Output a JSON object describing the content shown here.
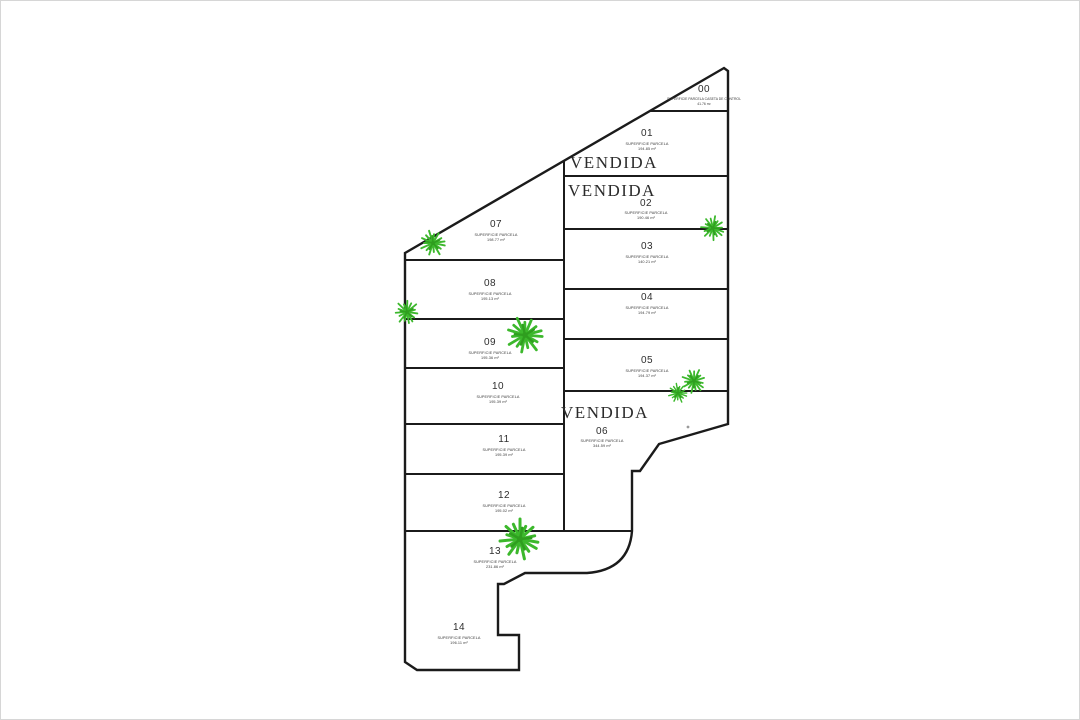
{
  "page": {
    "type": "parcel-plan",
    "background": "#ffffff",
    "border_color": "#d6d6d6",
    "line_color": "#1b1b1b",
    "palm_green": "#3cb82c",
    "palm_green_dark": "#2f9e1f",
    "text_color": "#2e2e2e"
  },
  "labels": {
    "superficie": "SUPERFICIE PARCELA",
    "superficie_caseta": "SUPERFICIE PARCELA CASETA DE CONTROL",
    "vendida": "VENDIDA"
  },
  "parcels": [
    {
      "number": "00",
      "area": "41.76 m²"
    },
    {
      "number": "01",
      "area": "194.85 m²",
      "status": "VENDIDA"
    },
    {
      "number": "02",
      "area": "190.46 m²",
      "status": "VENDIDA"
    },
    {
      "number": "03",
      "area": "140.21 m²"
    },
    {
      "number": "04",
      "area": "194.79 m²"
    },
    {
      "number": "05",
      "area": "194.37 m²"
    },
    {
      "number": "06",
      "area": "344.59 m²",
      "status": "VENDIDA"
    },
    {
      "number": "07",
      "area": "198.77 m²"
    },
    {
      "number": "08",
      "area": "195.13 m²"
    },
    {
      "number": "09",
      "area": "195.36 m²"
    },
    {
      "number": "10",
      "area": "195.39 m²"
    },
    {
      "number": "11",
      "area": "195.39 m²"
    },
    {
      "number": "12",
      "area": "195.02 m²"
    },
    {
      "number": "13",
      "area": "231.86 m²"
    },
    {
      "number": "14",
      "area": "196.11 m²"
    }
  ]
}
